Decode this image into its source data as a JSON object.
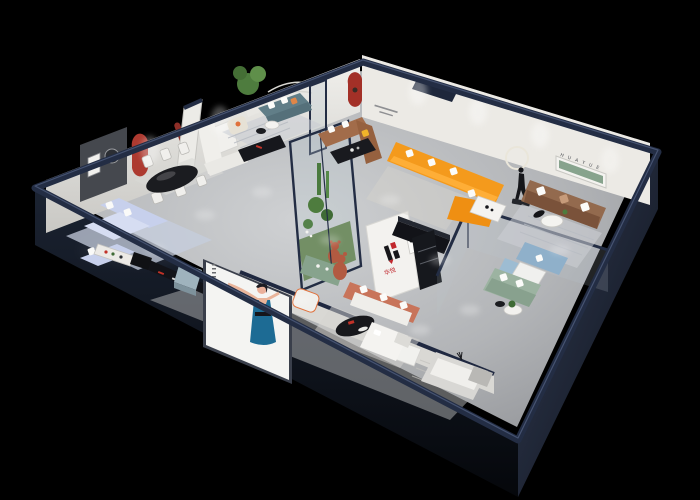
{
  "scene": {
    "description": "Isometric cutaway 3D render of a furniture showroom floor plan on a black background",
    "brand": {
      "logo_mark": "H",
      "name_cn": "华悦",
      "wall_letters": "H U A Y U E"
    },
    "palette": {
      "background": "#000000",
      "wall_top_navy": "#232d44",
      "wall_face_light": "#e9e8e3",
      "floor_gray": "#b5b7ba",
      "accent_red": "#ad3a30",
      "brand_red": "#c1272d",
      "brand_black": "#17171a",
      "sofa_blue": "#c7d0ec",
      "sofa_teal": "#617e88",
      "sofa_white": "#f0efeb",
      "sofa_cream": "#e6e1d5",
      "sofa_brown": "#a26c4a",
      "sofa_leather": "#936a4e",
      "sofa_orange": "#f49a1c",
      "sofa_coral": "#c8745a",
      "sofa_sage": "#9cb3a1",
      "sofa_skyblue": "#8fb0ca",
      "bed_gray": "#d8d7d4",
      "niche_green": "#87a38d",
      "bear_terracotta": "#b25a41",
      "plant_green": "#4e7c3e",
      "poster_dress": "#1d6b94",
      "console_black": "#121318",
      "rug_blue": "#c5cdde",
      "glass_tint": "#aebfca"
    },
    "rooms": [
      "dining-area",
      "blue-sofa-lounge",
      "teal-sofa-lounge",
      "white-sofa-lounge",
      "brown-sofa-lounge",
      "orange-sofa-showcase",
      "leather-sofa-room",
      "glass-meeting-room",
      "bedroom-display-strip",
      "front-gallery",
      "glass-atrium"
    ]
  }
}
